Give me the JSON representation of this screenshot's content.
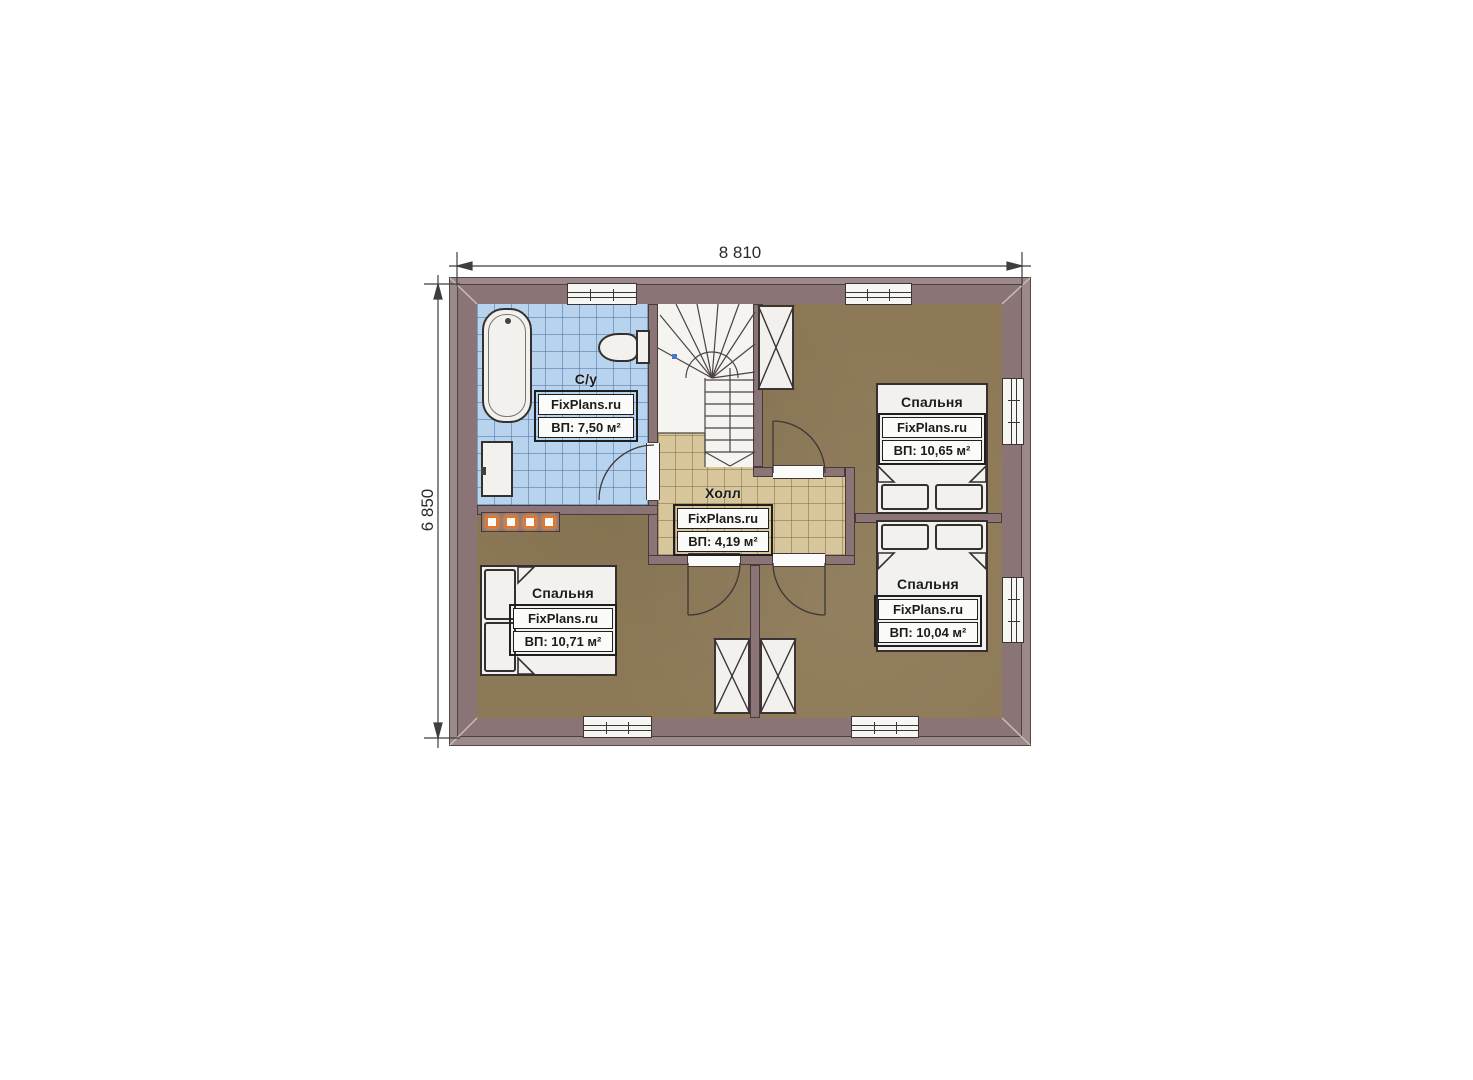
{
  "plan": {
    "title": "Floor plan (2nd floor)",
    "dimension_width": "8 810",
    "dimension_height": "6 850",
    "rooms": {
      "bathroom": {
        "title": "С/у",
        "brand": "FixPlans.ru",
        "area": "ВП: 7,50 м²"
      },
      "hall": {
        "title": "Холл",
        "brand": "FixPlans.ru",
        "area": "ВП: 4,19 м²"
      },
      "bedroom_tr": {
        "title": "Спальня",
        "brand": "FixPlans.ru",
        "area": "ВП: 10,65 м²"
      },
      "bedroom_br": {
        "title": "Спальня",
        "brand": "FixPlans.ru",
        "area": "ВП: 10,04 м²"
      },
      "bedroom_bl": {
        "title": "Спальня",
        "brand": "FixPlans.ru",
        "area": "ВП: 10,71 м²"
      }
    },
    "colors": {
      "wall": "#8b7475",
      "eave": "#9c8a8b",
      "bathroom_tile": "#b8d3ee",
      "hall_tile": "#d7c59b",
      "bedroom_floor": "#8d7957",
      "radiator_accent": "#e2762a",
      "fixture_fill": "#f2f1ee"
    }
  }
}
